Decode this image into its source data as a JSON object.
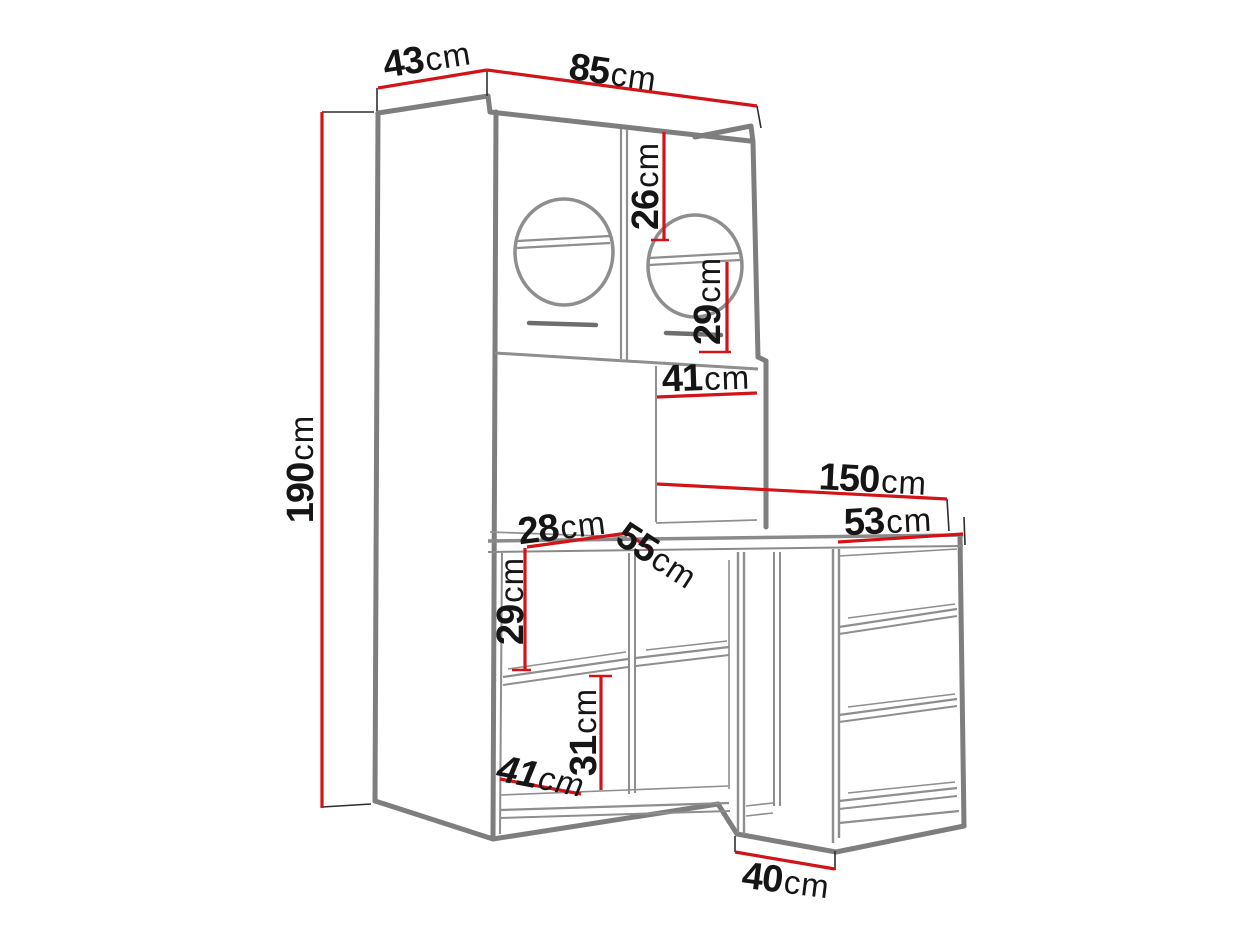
{
  "figure": {
    "type": "furniture-dimension-diagram",
    "background": "#ffffff"
  },
  "colors": {
    "dimension_line": "#d21317",
    "structure_line": "#7e7e7e",
    "label_text": "#151515"
  },
  "dimensions": {
    "d43": {
      "value": "43",
      "unit": "cm"
    },
    "d85": {
      "value": "85",
      "unit": "cm"
    },
    "d26": {
      "value": "26",
      "unit": "cm"
    },
    "d29_upper": {
      "value": "29",
      "unit": "cm"
    },
    "d41_upper": {
      "value": "41",
      "unit": "cm"
    },
    "d150": {
      "value": "150",
      "unit": "cm"
    },
    "d53": {
      "value": "53",
      "unit": "cm"
    },
    "d28": {
      "value": "28",
      "unit": "cm"
    },
    "d55": {
      "value": "55",
      "unit": "cm"
    },
    "d29_lower": {
      "value": "29",
      "unit": "cm"
    },
    "d31": {
      "value": "31",
      "unit": "cm"
    },
    "d41_lower": {
      "value": "41",
      "unit": "cm"
    },
    "d190": {
      "value": "190",
      "unit": "cm"
    },
    "d40": {
      "value": "40",
      "unit": "cm"
    }
  }
}
